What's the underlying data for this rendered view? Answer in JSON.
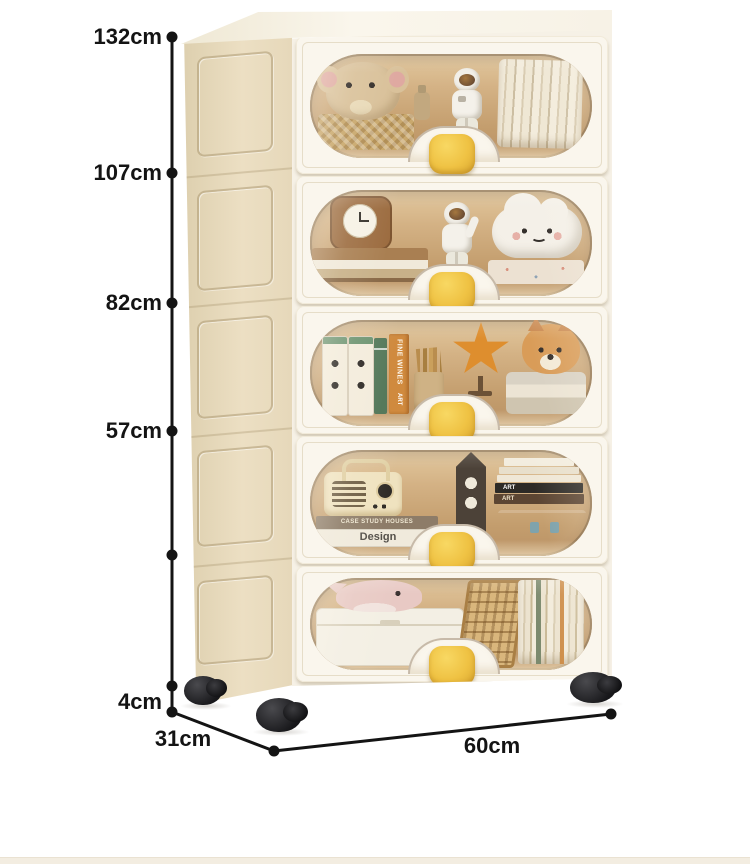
{
  "scene": {
    "description": "Product photo of a five-tier cream plastic storage cabinet with transparent amber front windows, yellow oval handles and black casters, annotated with size dimensions",
    "background": "#ffffff"
  },
  "palette": {
    "cabinet_front": "#f9f5ec",
    "cabinet_side": "#e8dcc0",
    "window_tint": "#cfae7e",
    "handle_yellow": "#eec243",
    "wheel_black": "#1f1f22",
    "annotation_ink": "#141414"
  },
  "dims": {
    "h132": "132cm",
    "h107": "107cm",
    "h82": "82cm",
    "h57": "57cm",
    "h4": "4cm",
    "d31": "31cm",
    "w60": "60cm"
  },
  "texts": {
    "fine_wines": "FINE WINES",
    "art_spine": "ART",
    "case_study": "CASE STUDY HOUSES",
    "design": "Design",
    "art_black": "ART",
    "art_brown": "ART"
  },
  "tiers": [
    {
      "id": 1,
      "contents": [
        "elephant plush",
        "woven basket",
        "lotion bottle",
        "astronaut figurine",
        "stack of books"
      ]
    },
    {
      "id": 2,
      "contents": [
        "wooden clock",
        "stacked books",
        "astronaut figurine waving",
        "smiling cloud plush",
        "patterned box"
      ]
    },
    {
      "id": 3,
      "contents": [
        "two white ring binders",
        "green book",
        "FINE WINES ART book",
        "pencil cup with pencils",
        "starfish ornament on stand",
        "shiba dog plush on folded blankets"
      ]
    },
    {
      "id": 4,
      "contents": [
        "retro radio",
        "CASE STUDY HOUSES book",
        "Design book",
        "clock tower ornament",
        "stack of art books",
        "wooden chest"
      ]
    },
    {
      "id": 5,
      "contents": [
        "pink whale plush",
        "white storage box",
        "wooden abacus",
        "row of books"
      ]
    }
  ]
}
